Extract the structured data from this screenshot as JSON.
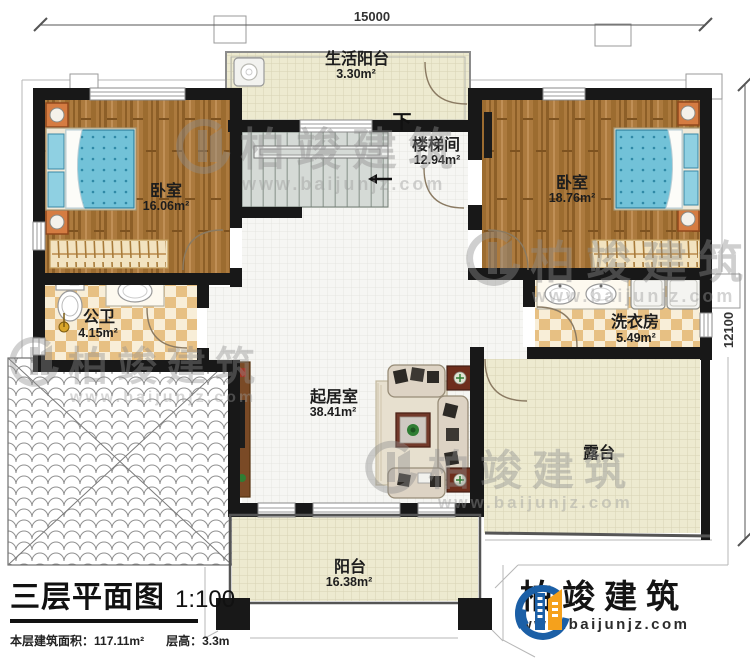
{
  "plan": {
    "title": "三层平面图",
    "scale": "1:100",
    "floor_area_label": "本层建筑面积：",
    "floor_area_value": "117.11m²",
    "floor_height_label": "层高：",
    "floor_height_value": "3.3m",
    "dim_width": "15000",
    "dim_height": "12100",
    "stair_down_label": "下"
  },
  "rooms": [
    {
      "id": "service-balcony",
      "name": "生活阳台",
      "area": "3.30m²"
    },
    {
      "id": "stair-hall",
      "name": "楼梯间",
      "area": "12.94m²"
    },
    {
      "id": "bedroom-left",
      "name": "卧室",
      "area": "16.06m²"
    },
    {
      "id": "bedroom-right",
      "name": "卧室",
      "area": "18.76m²"
    },
    {
      "id": "bathroom",
      "name": "公卫",
      "area": "4.15m²"
    },
    {
      "id": "laundry",
      "name": "洗衣房",
      "area": "5.49m²"
    },
    {
      "id": "living-room",
      "name": "起居室",
      "area": "38.41m²"
    },
    {
      "id": "terrace",
      "name": "露台",
      "area": ""
    },
    {
      "id": "balcony",
      "name": "阳台",
      "area": "16.38m²"
    }
  ],
  "branding": {
    "company": "柏竣建筑",
    "website": "www.baijunjz.com"
  },
  "colors": {
    "wall": "#181818",
    "wood_floor": "#ac7a3e",
    "tile_beige": "#edead0",
    "checker_tile": "#e7c083",
    "bed_blue": "#72c2d8",
    "logo_blue": "#1b5fa6",
    "logo_orange": "#f5a11c"
  }
}
